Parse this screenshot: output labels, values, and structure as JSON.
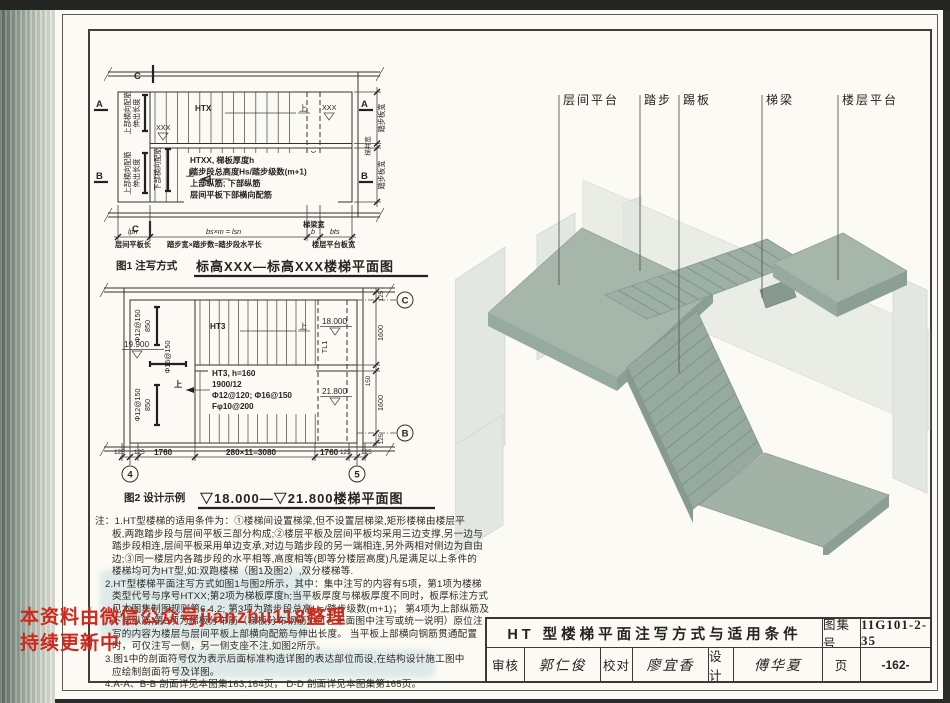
{
  "watermark": {
    "line1": "本资料由微信公众号jianzhu118整理",
    "line2": "持续更新中",
    "color": "#cd2a1e"
  },
  "iso": {
    "labels": [
      "层间平台",
      "踏步",
      "踢板",
      "梯梁",
      "楼层平台"
    ],
    "colors": {
      "slab_top": "#a7b6ab",
      "slab_side": "#8b9f94",
      "flight": "#9db0a5",
      "wall": "#dbe0da"
    }
  },
  "fig1": {
    "caption_label": "图1 注写方式",
    "caption_title": "标高XXX—标高XXX楼梯平面图",
    "code_label": "HTX",
    "up_label": "上",
    "beam_rot_label": "TLX",
    "elev_top": "XXX",
    "elev_mid": "XXX",
    "elev_bottom": "XXX",
    "note_line1": "HTXX, 梯板厚度h",
    "note_line2": "踏步段总高度Hs/踏步级数(m+1)",
    "note_line3": "上部纵筋; 下部纵筋",
    "note_line4": "层间平板下部横向配筋",
    "left_top_label1": "上部横向配筋",
    "left_top_label2": "伸出长度",
    "left_bottom_label1": "上部横向配筋",
    "left_bottom_label2": "伸出长度",
    "left_bottom_label3": "下部横向配筋",
    "right_width_top": "踏步板宽",
    "right_width_mid": "梯井宽",
    "right_width_bottom": "踏步板宽",
    "dim_sym_platform": "lpn",
    "dim_sym_steps": "bs×m = lsn",
    "dim_sym_beam": "b",
    "dim_sym_floor": "bts",
    "dim_label_platform": "层间平板长",
    "dim_label_steps": "踏步宽×踏步数=踏步段水平长",
    "dim_label_beam": "梯梁宽",
    "dim_label_floor": "楼层平台板宽",
    "section_a": "A",
    "section_b": "B",
    "section_c": "C"
  },
  "fig2": {
    "caption_label": "图2 设计示例",
    "caption_title": "▽18.000—▽21.800楼梯平面图",
    "code_label": "HT3",
    "up_label": "上",
    "beam_rot_label": "TL1",
    "elev_top": "18.000",
    "elev_mid": "19.900",
    "elev_bottom": "21.800",
    "note_line1": "HT3, h=160",
    "note_line2": "1900/12",
    "note_line3": "Φ12@120; Φ16@150",
    "note_line4": "Fφ10@200",
    "rebar_top1": "Φ12@150",
    "rebar_top2": "850",
    "rebar_mid": "Φ16@150",
    "rebar_bottom1": "Φ12@150",
    "rebar_bottom2": "850",
    "dims_bottom": [
      "125",
      "125",
      "1760",
      "280×11=3080",
      "1760",
      "125",
      "125"
    ],
    "dims_right": [
      "125",
      "1600",
      "150",
      "1600",
      "125"
    ],
    "grid_left": "4",
    "grid_right": "5",
    "grid_top": "C",
    "grid_bottom": "B"
  },
  "notes": {
    "lines": [
      "注：1.HT型楼梯的适用条件为：①楼梯间设置梯梁,但不设置层梯梁,矩形楼梯由楼层平",
      "板,两跑踏步段与层间平板三部分构成;②楼层平板及层间平板均采用三边支撑,另一边与",
      "踏步段相连,层间平板采用单边支承,对边与踏步段的另一端相连,另外两相对侧边为自由",
      "边;③同一楼层内各踏步段的水平相等,高度相等(即等分楼层高度)凡是满足以上条件的",
      "楼梯均可为HT型,如:双跑楼梯（图1及图2）,双分楼梯等.",
      "2.HT型楼梯平面注写方式如图1与图2所示，其中：集中注写的内容有5项，第1项为楼梯",
      "类型代号与序号HTXX;第2项为梯板厚度h;当平板厚度与梯板厚度不同时，板厚标注方式",
      "见本图集制图规则第6.4.2; 第3项为踏步段总高Hs/踏步级数(m+1)； 第4项为上部纵筋及",
      "下部纵筋;第5项为梯板分布筋（梯板分布钢筋也可在平面图中注写或统一说明）原位注",
      "写的内容为楼层与层间平板上部横向配筋与伸出长度。 当平板上部横向钢筋贯通配置",
      "时，可仅注写一侧，另一侧支座不注,如图2所示。",
      "3.图1中的剖面符号仅为表示后面标准构造详图的表达部位而设,在结构设计施工图中",
      "应绘制剖面符号及详图。",
      "4.A-A、B-B 剖面详见本图集163,164页， D-D 剖面详见本图集第165页。"
    ]
  },
  "titleblock": {
    "title": "HT 型楼梯平面注写方式与适用条件",
    "atlas_label": "图集号",
    "atlas_no": "11G101-2-35",
    "page_label": "页",
    "page_no": "-162-",
    "reviewer_label": "审核",
    "reviewer_name": "郭仁俊",
    "checker_label": "校对",
    "checker_name": "廖宜香",
    "designer_label": "设计",
    "designer_name": "傅华夏"
  }
}
